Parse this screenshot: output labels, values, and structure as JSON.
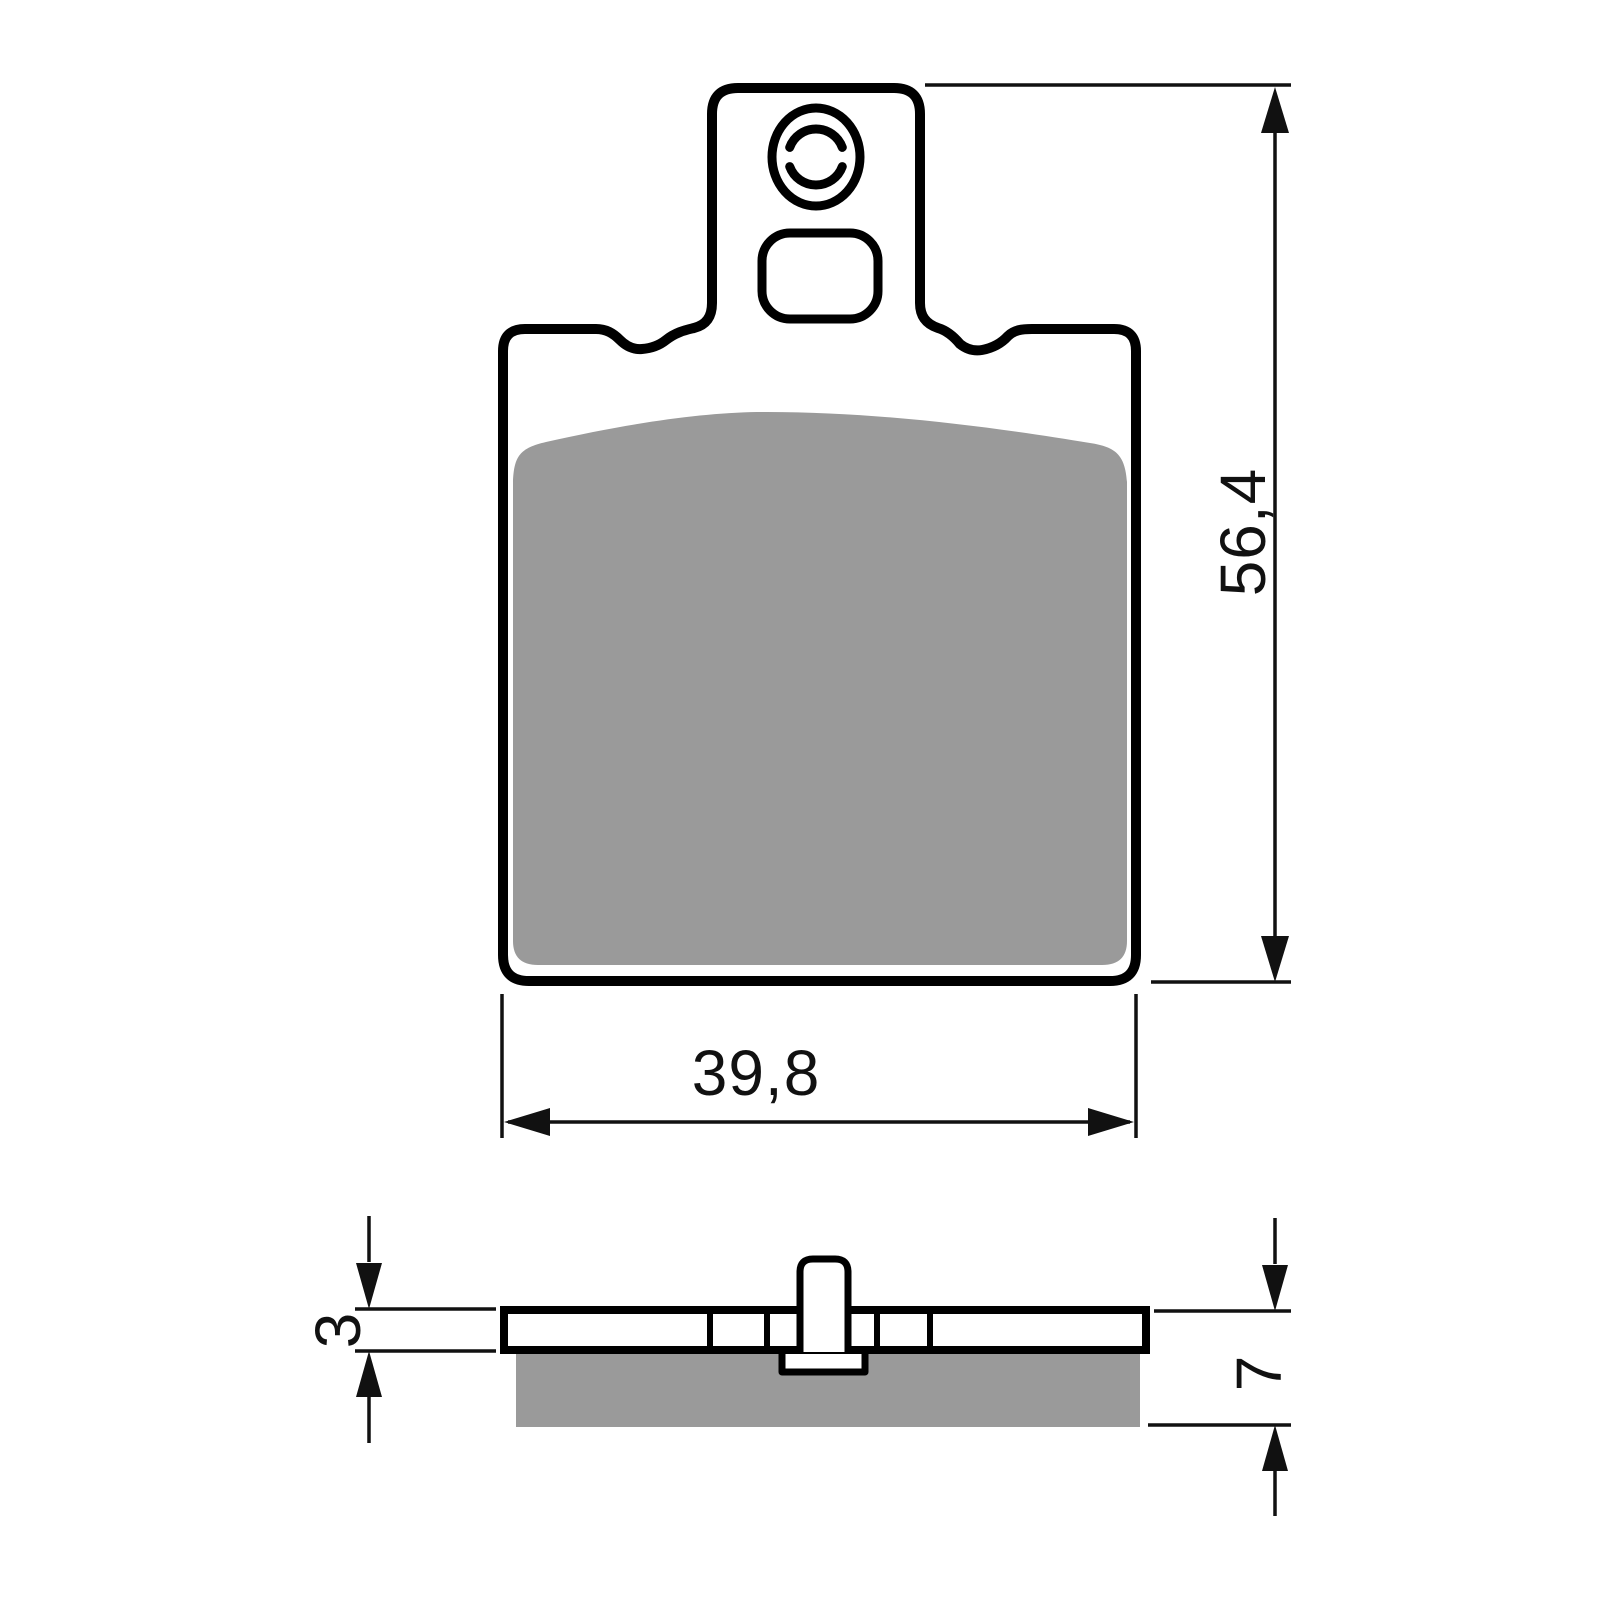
{
  "diagram": {
    "kind": "brake-pad-technical-drawing",
    "views": {
      "front": {
        "height_label": "56,4",
        "width_label": "39,8"
      },
      "side": {
        "plate_thickness_label": "3",
        "total_thickness_label": "7"
      }
    },
    "icons": {
      "round_hole": "round-pin-hole",
      "square_hole": "square-pin-hole"
    },
    "colors": {
      "outline": "#000000",
      "dimension": "#111111",
      "friction": "#9a9a9a",
      "background": "#ffffff",
      "fill": "#ffffff"
    }
  }
}
